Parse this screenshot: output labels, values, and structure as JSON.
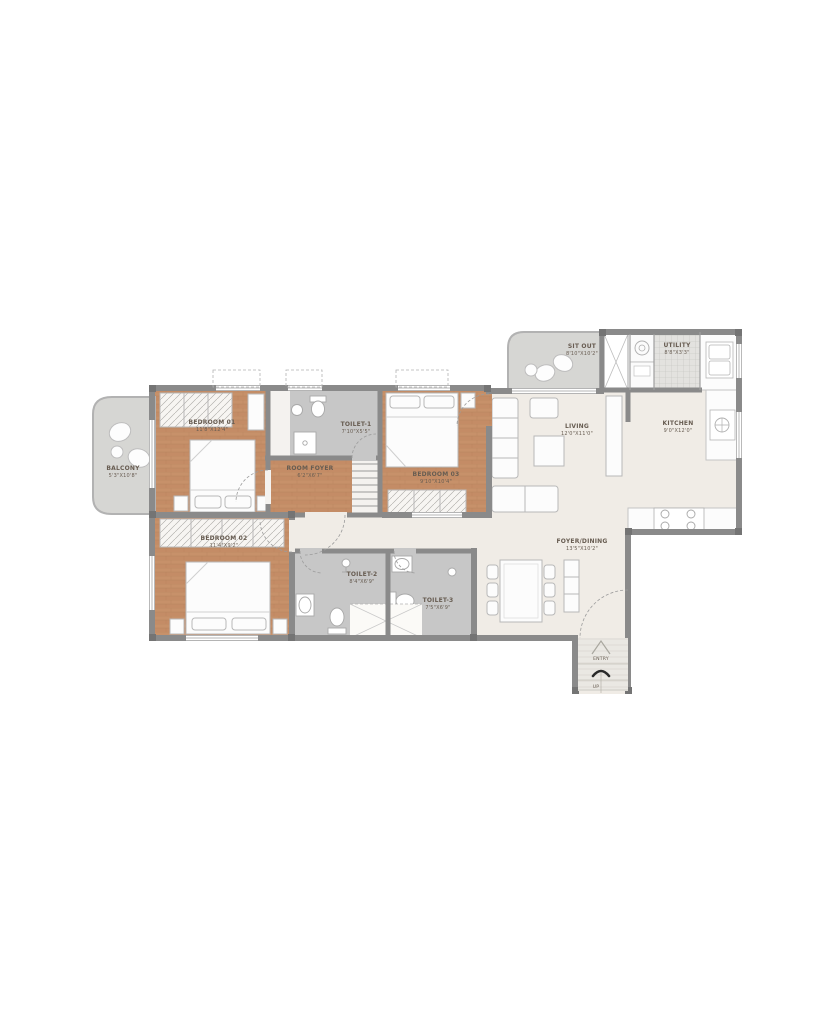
{
  "plan": {
    "title": "3 BHK Floor Plan",
    "colors": {
      "wall_gray": "#8a8a8a",
      "wood_floor": "#c7916a",
      "toilet_gray": "#c7c7c7",
      "light_floor": "#f0ece6",
      "deck_gray": "#dddcda",
      "label_brown": "#675c51"
    },
    "rooms": {
      "balcony": {
        "label": "BALCONY",
        "dims": "5'3\"X10'8\""
      },
      "bedroom_01": {
        "label": "BEDROOM 01",
        "dims": "11'8\"X12'4\""
      },
      "toilet_1": {
        "label": "TOILET-1",
        "dims": "7'10\"X5'5\""
      },
      "room_foyer": {
        "label": "ROOM FOYER",
        "dims": "6'2\"X6'7\""
      },
      "bedroom_03": {
        "label": "BEDROOM 03",
        "dims": "9'10\"X10'4\""
      },
      "sit_out": {
        "label": "SIT OUT",
        "dims": "8'10\"X10'2\""
      },
      "utility": {
        "label": "UTILITY",
        "dims": "8'8\"X3'3\""
      },
      "kitchen": {
        "label": "KITCHEN",
        "dims": "9'0\"X12'0\""
      },
      "living": {
        "label": "LIVING",
        "dims": "12'0\"X11'0\""
      },
      "foyer_dining": {
        "label": "FOYER/DINING",
        "dims": "13'5\"X10'2\""
      },
      "bedroom_02": {
        "label": "BEDROOM 02",
        "dims": "11'4\"X9'2\""
      },
      "toilet_2": {
        "label": "TOILET-2",
        "dims": "8'4\"X6'9\""
      },
      "toilet_3": {
        "label": "TOILET-3",
        "dims": "7'5\"X6'9\""
      }
    },
    "entry": {
      "label": "ENTRY",
      "up": "UP"
    }
  }
}
